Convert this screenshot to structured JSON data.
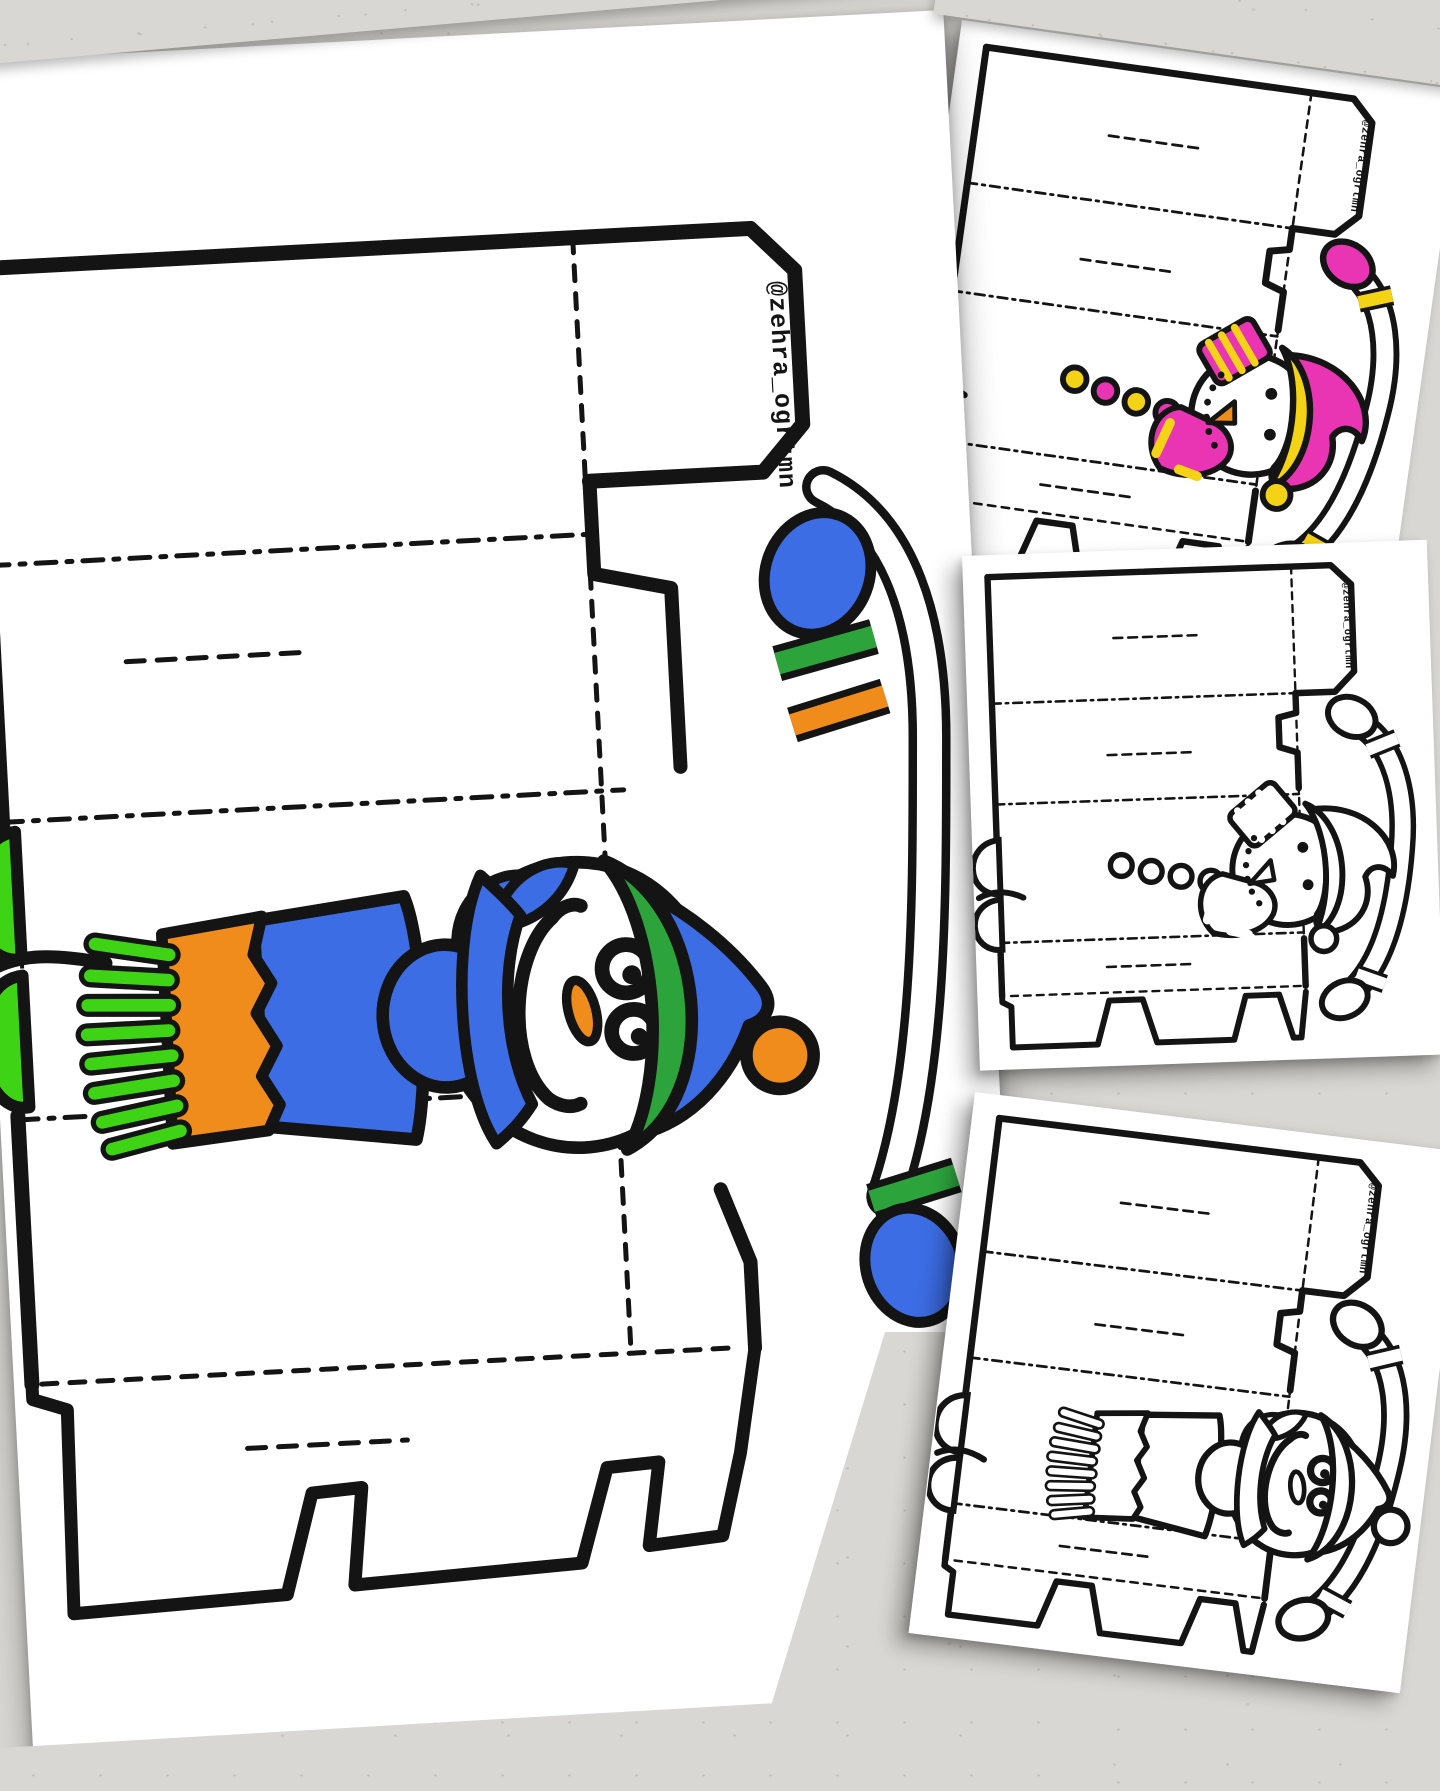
{
  "watermark": "@zehra_ogrtmn",
  "colors": {
    "bg": "#d8d7d3",
    "paper": "#ffffff",
    "ink": "#141414",
    "blue": "#3d6de4",
    "green": "#2da33c",
    "brightGreen": "#3ed315",
    "orange": "#f08c1c",
    "pink": "#e935b4",
    "yellow": "#f4d316"
  },
  "sheets": [
    {
      "id": "main",
      "name": "large snowman gift-box template sheet",
      "color_scheme": "blue-green-orange",
      "snowman_style": "smiling snowman, fringe scarf, pompom hat"
    },
    {
      "id": "top",
      "name": "small template card (colored)",
      "color_scheme": "pink-yellow",
      "snowman_style": "dot-mouth snowman, striped scarf, floppy beanie"
    },
    {
      "id": "middle",
      "name": "small template card (black & white)",
      "color_scheme": "uncolored",
      "snowman_style": "dot-mouth snowman, striped scarf, floppy beanie"
    },
    {
      "id": "bottom",
      "name": "small template card (black & white)",
      "color_scheme": "uncolored",
      "snowman_style": "smiling snowman, fringe scarf, pompom hat"
    }
  ]
}
